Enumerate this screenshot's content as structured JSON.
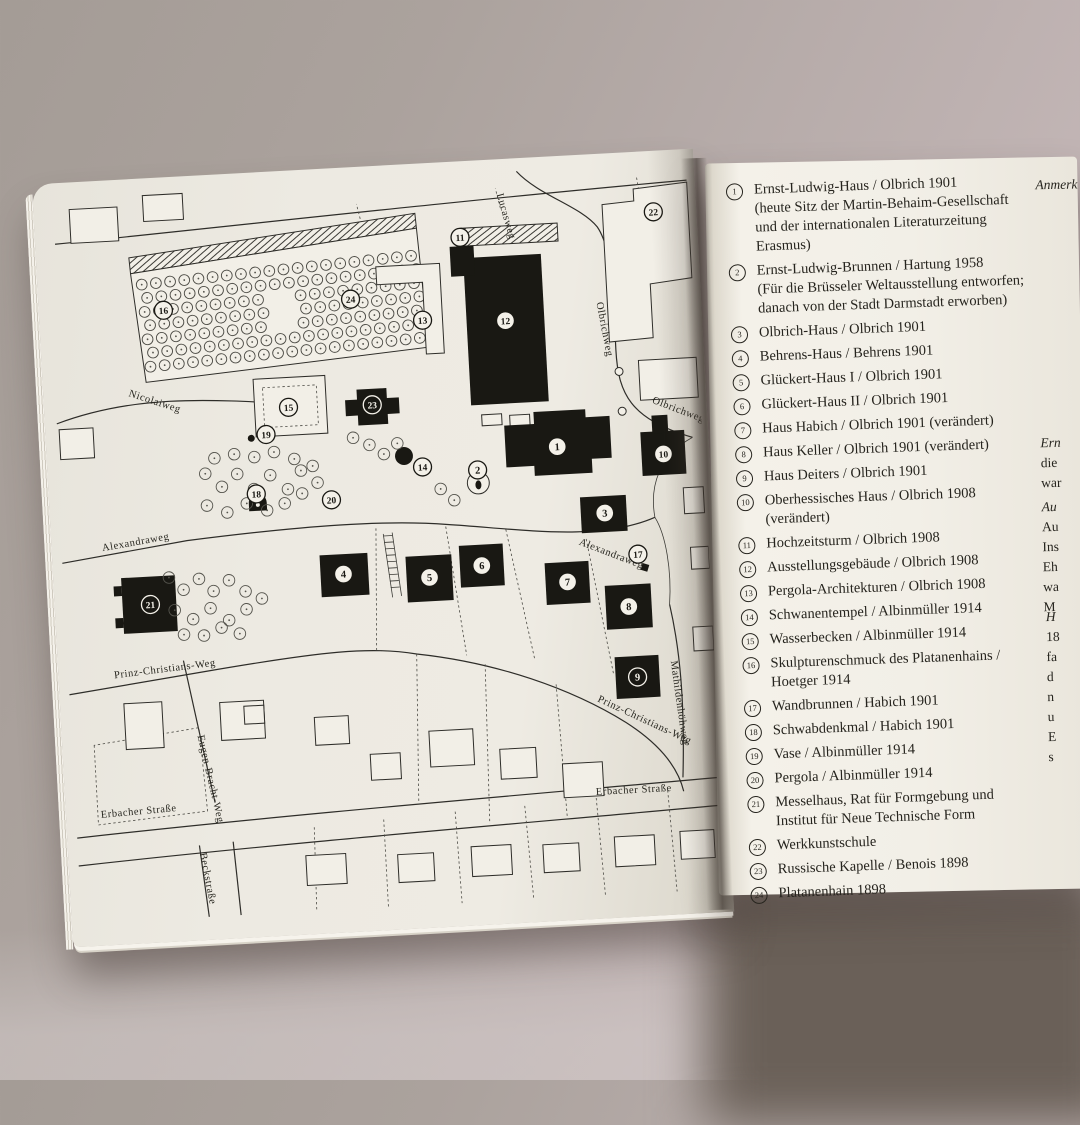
{
  "colors": {
    "backdrop": "#b2a8a5",
    "page_left": "#edeae2",
    "page_right": "#f2efe7",
    "ink": "#26241e"
  },
  "map": {
    "street_labels": [
      {
        "text": "Lucasweg",
        "x": 457,
        "y": 26,
        "r": 77
      },
      {
        "text": "Olbrichweg",
        "x": 551,
        "y": 140,
        "r": 82
      },
      {
        "text": "Olbrichweg",
        "x": 601,
        "y": 243,
        "r": 24
      },
      {
        "text": "Nicolaiweg",
        "x": 77,
        "y": 208,
        "r": 21
      },
      {
        "text": "Alexandraweg",
        "x": 43,
        "y": 362,
        "r": -7
      },
      {
        "text": "Alexandraweg",
        "x": 520,
        "y": 381,
        "r": 24
      },
      {
        "text": "Prinz-Christians-Weg",
        "x": 48,
        "y": 490,
        "r": -4
      },
      {
        "text": "Prinz-Christians-Weg",
        "x": 530,
        "y": 539,
        "r": 28
      },
      {
        "text": "Eugen-Bracht-Weg",
        "x": 128,
        "y": 552,
        "r": 80
      },
      {
        "text": "Mathildenhöhweg",
        "x": 606,
        "y": 503,
        "r": 85
      },
      {
        "text": "Erbacher Straße",
        "x": 27,
        "y": 629,
        "r": -2
      },
      {
        "text": "Erbacher Straße",
        "x": 524,
        "y": 633,
        "r": 0
      },
      {
        "text": "Beckstraße",
        "x": 124,
        "y": 670,
        "r": 82
      }
    ],
    "markers": [
      {
        "n": "1",
        "x": 504,
        "y": 282,
        "inv": false
      },
      {
        "n": "2",
        "x": 423,
        "y": 301,
        "inv": false
      },
      {
        "n": "3",
        "x": 548,
        "y": 351,
        "inv": false
      },
      {
        "n": "4",
        "x": 283,
        "y": 398,
        "inv": false
      },
      {
        "n": "5",
        "x": 369,
        "y": 406,
        "inv": false
      },
      {
        "n": "6",
        "x": 422,
        "y": 397,
        "inv": false
      },
      {
        "n": "7",
        "x": 507,
        "y": 418,
        "inv": false
      },
      {
        "n": "8",
        "x": 567,
        "y": 446,
        "inv": false
      },
      {
        "n": "9",
        "x": 572,
        "y": 517,
        "inv": true
      },
      {
        "n": "10",
        "x": 610,
        "y": 295,
        "inv": false
      },
      {
        "n": "11",
        "x": 418,
        "y": 67,
        "inv": false
      },
      {
        "n": "12",
        "x": 459,
        "y": 153,
        "inv": false
      },
      {
        "n": "13",
        "x": 376,
        "y": 148,
        "inv": false
      },
      {
        "n": "14",
        "x": 368,
        "y": 295,
        "inv": false
      },
      {
        "n": "15",
        "x": 237,
        "y": 228,
        "inv": false
      },
      {
        "n": "16",
        "x": 117,
        "y": 124,
        "inv": false
      },
      {
        "n": "17",
        "x": 579,
        "y": 394,
        "inv": false
      },
      {
        "n": "18",
        "x": 200,
        "y": 313,
        "inv": false
      },
      {
        "n": "19",
        "x": 213,
        "y": 254,
        "inv": false
      },
      {
        "n": "20",
        "x": 275,
        "y": 323,
        "inv": false
      },
      {
        "n": "21",
        "x": 88,
        "y": 418,
        "inv": true
      },
      {
        "n": "22",
        "x": 613,
        "y": 52,
        "inv": false
      },
      {
        "n": "23",
        "x": 321,
        "y": 230,
        "inv": true
      },
      {
        "n": "24",
        "x": 305,
        "y": 123,
        "inv": false
      }
    ]
  },
  "right_page": {
    "legend": [
      {
        "num": "1",
        "lines": [
          "Ernst-Ludwig-Haus / Olbrich 1901",
          "(heute Sitz der Martin-Behaim-Gesellschaft",
          "und der internationalen Literaturzeitung Erasmus)"
        ]
      },
      {
        "num": "2",
        "lines": [
          "Ernst-Ludwig-Brunnen / Hartung 1958",
          "(Für die Brüsseler Weltausstellung entworfen;",
          "danach von der Stadt Darmstadt erworben)"
        ]
      },
      {
        "num": "3",
        "lines": [
          "Olbrich-Haus / Olbrich 1901"
        ]
      },
      {
        "num": "4",
        "lines": [
          "Behrens-Haus / Behrens 1901"
        ]
      },
      {
        "num": "5",
        "lines": [
          "Glückert-Haus I / Olbrich 1901"
        ]
      },
      {
        "num": "6",
        "lines": [
          "Glückert-Haus II / Olbrich 1901"
        ]
      },
      {
        "num": "7",
        "lines": [
          "Haus Habich / Olbrich 1901 (verändert)"
        ]
      },
      {
        "num": "8",
        "lines": [
          "Haus Keller / Olbrich 1901 (verändert)"
        ]
      },
      {
        "num": "9",
        "lines": [
          "Haus Deiters / Olbrich 1901"
        ]
      },
      {
        "num": "10",
        "lines": [
          "Oberhessisches Haus / Olbrich 1908 (verändert)"
        ]
      },
      {
        "num": "11",
        "lines": [
          "Hochzeitsturm / Olbrich 1908"
        ]
      },
      {
        "num": "12",
        "lines": [
          "Ausstellungsgebäude / Olbrich 1908"
        ]
      },
      {
        "num": "13",
        "lines": [
          "Pergola-Architekturen / Olbrich 1908"
        ]
      },
      {
        "num": "14",
        "lines": [
          "Schwanentempel / Albinmüller 1914"
        ]
      },
      {
        "num": "15",
        "lines": [
          "Wasserbecken / Albinmüller 1914"
        ]
      },
      {
        "num": "16",
        "lines": [
          "Skulpturenschmuck des Platanenhains / Hoetger 1914"
        ]
      },
      {
        "num": "17",
        "lines": [
          "Wandbrunnen / Habich 1901"
        ]
      },
      {
        "num": "18",
        "lines": [
          "Schwabdenkmal / Habich 1901"
        ]
      },
      {
        "num": "19",
        "lines": [
          "Vase / Albinmüller 1914"
        ]
      },
      {
        "num": "20",
        "lines": [
          "Pergola / Albinmüller 1914"
        ]
      },
      {
        "num": "21",
        "lines": [
          "Messelhaus, Rat für Formgebung und",
          "Institut für Neue Technische Form"
        ]
      },
      {
        "num": "22",
        "lines": [
          "Werkkunstschule"
        ]
      },
      {
        "num": "23",
        "lines": [
          "Russische Kapelle / Benois 1898"
        ]
      },
      {
        "num": "24",
        "lines": [
          "Platanenhain 1898"
        ]
      }
    ],
    "margin_notes": [
      {
        "lines": [
          "Anmerk"
        ],
        "italic_first": true
      },
      {
        "lines": [
          "Ern",
          "die",
          "war"
        ],
        "italic_first": true
      },
      {
        "lines": [
          "Au",
          "Au",
          "Ins",
          "Eh",
          "wa",
          "M"
        ],
        "italic_first": true
      },
      {
        "lines": [
          "H",
          "18",
          "fa",
          "d",
          "n",
          "u",
          "E",
          "s"
        ],
        "italic_first": true
      }
    ]
  }
}
